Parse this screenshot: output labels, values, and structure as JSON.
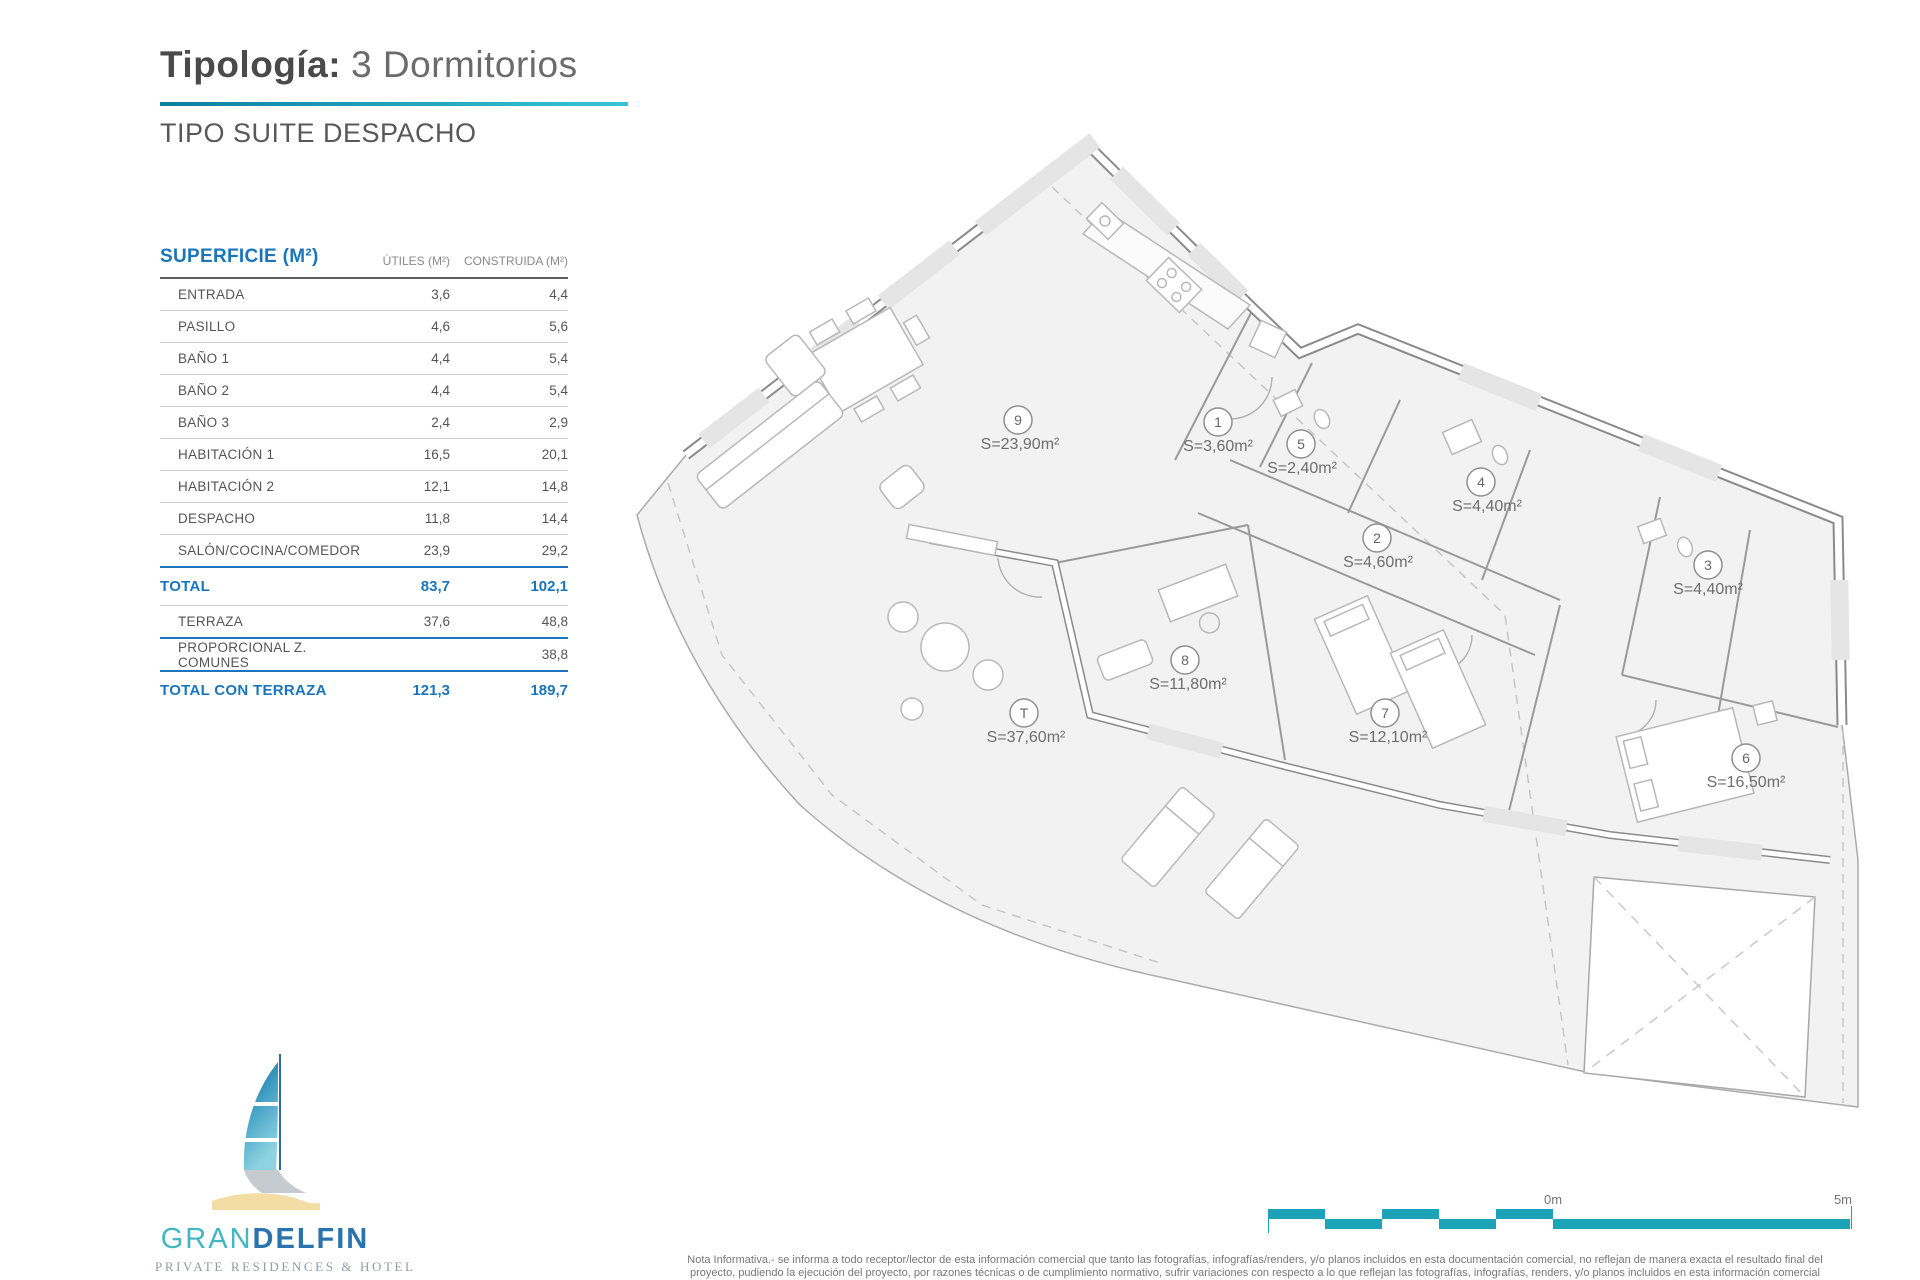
{
  "header": {
    "title_bold": "Tipología:",
    "title_light": "3 Dormitorios",
    "subtitle": "TIPO SUITE DESPACHO"
  },
  "table": {
    "header": {
      "col1": "SUPERFICIE (M²)",
      "col2": "ÚTILES (M²)",
      "col3": "CONSTRUIDA (M²)"
    },
    "rows": [
      {
        "label": "ENTRADA",
        "utiles": "3,6",
        "construida": "4,4"
      },
      {
        "label": "PASILLO",
        "utiles": "4,6",
        "construida": "5,6"
      },
      {
        "label": "BAÑO 1",
        "utiles": "4,4",
        "construida": "5,4"
      },
      {
        "label": "BAÑO 2",
        "utiles": "4,4",
        "construida": "5,4"
      },
      {
        "label": "BAÑO 3",
        "utiles": "2,4",
        "construida": "2,9"
      },
      {
        "label": "HABITACIÓN 1",
        "utiles": "16,5",
        "construida": "20,1"
      },
      {
        "label": "HABITACIÓN 2",
        "utiles": "12,1",
        "construida": "14,8"
      },
      {
        "label": "DESPACHO",
        "utiles": "11,8",
        "construida": "14,4"
      },
      {
        "label": "SALÓN/COCINA/COMEDOR",
        "utiles": "23,9",
        "construida": "29,2"
      }
    ],
    "total": {
      "label": "TOTAL",
      "utiles": "83,7",
      "construida": "102,1"
    },
    "extra_rows": [
      {
        "label": "TERRAZA",
        "utiles": "37,6",
        "construida": "48,8"
      },
      {
        "label": "PROPORCIONAL Z. COMUNES",
        "utiles": "",
        "construida": "38,8"
      }
    ],
    "total_terraza": {
      "label": "TOTAL CON TERRAZA",
      "utiles": "121,3",
      "construida": "189,7"
    }
  },
  "plan": {
    "rooms": [
      {
        "number": "9",
        "area": "S=23,90m²"
      },
      {
        "number": "1",
        "area": "S=3,60m²"
      },
      {
        "number": "5",
        "area": "S=2,40m²"
      },
      {
        "number": "4",
        "area": "S=4,40m²"
      },
      {
        "number": "2",
        "area": "S=4,60m²"
      },
      {
        "number": "3",
        "area": "S=4,40m²"
      },
      {
        "number": "8",
        "area": "S=11,80m²"
      },
      {
        "number": "T",
        "area": "S=37,60m²"
      },
      {
        "number": "7",
        "area": "S=12,10m²"
      },
      {
        "number": "6",
        "area": "S=16,50m²"
      }
    ]
  },
  "scale_bar": {
    "label_start": "0m",
    "label_end": "5m"
  },
  "logo": {
    "name_part1": "GRAN",
    "name_part2": "DELFIN",
    "subtitle": "PRIVATE RESIDENCES & HOTEL"
  },
  "footer": {
    "note_line1": "Nota Informativa.- se informa a todo receptor/lector de esta información comercial que tanto las fotografías, infografías/renders, y/o planos incluidos en esta documentación comercial, no reflejan de manera exacta el resultado final del",
    "note_line2": "proyecto, pudiendo la ejecución del proyecto, por razones técnicas o de cumplimiento normativo, sufrir variaciones con respecto a lo que reflejan las fotografías, infografías, renders, y/o planos incluidos en esta información comercial"
  },
  "colors": {
    "accent_teal": "#1ba7bc",
    "table_blue": "#1a75bc",
    "scalebar_teal": "#1ca3b8"
  }
}
